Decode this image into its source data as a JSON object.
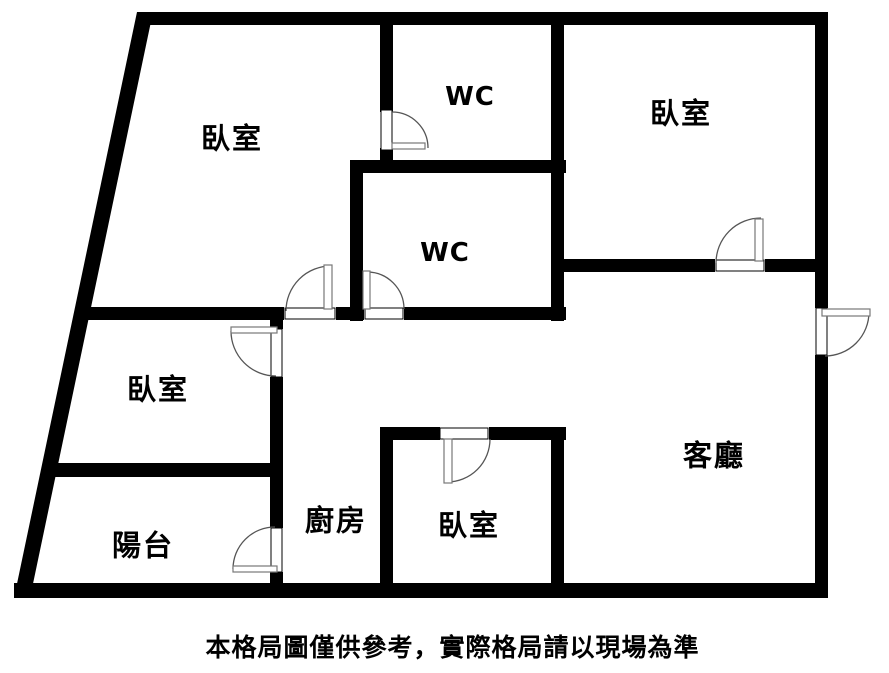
{
  "plan": {
    "rooms": [
      {
        "id": "bedroom-top-left",
        "label": "臥室"
      },
      {
        "id": "wc-upper",
        "label": "WC"
      },
      {
        "id": "bedroom-top-right",
        "label": "臥室"
      },
      {
        "id": "wc-lower",
        "label": "WC"
      },
      {
        "id": "bedroom-mid-left",
        "label": "臥室"
      },
      {
        "id": "living-room",
        "label": "客廳"
      },
      {
        "id": "kitchen",
        "label": "廚房"
      },
      {
        "id": "bedroom-bottom",
        "label": "臥室"
      },
      {
        "id": "balcony",
        "label": "陽台"
      }
    ],
    "caption": "本格局圖僅供參考，實際格局請以現場為準",
    "colors": {
      "wall": "#000000",
      "background": "#ffffff",
      "door_arc": "#555555"
    },
    "door_count": 8
  }
}
